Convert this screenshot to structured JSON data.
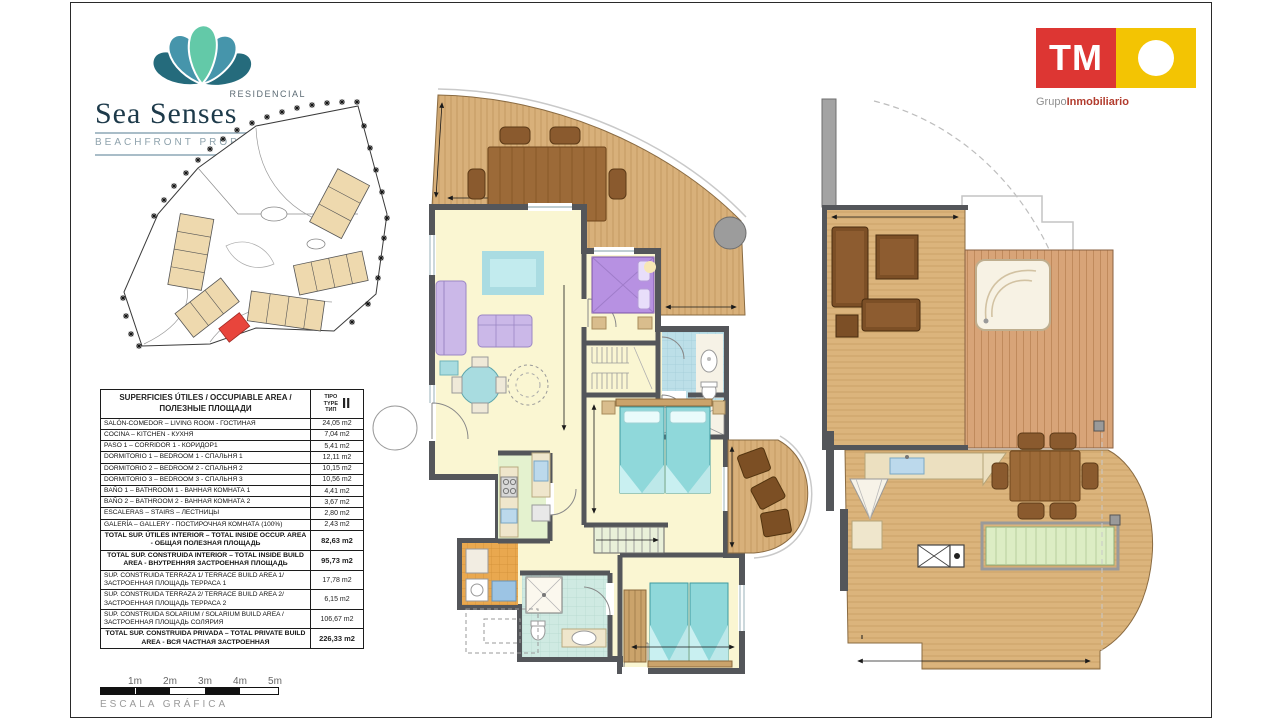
{
  "branding": {
    "residencial": "RESIDENCIAL",
    "name": "Sea Senses",
    "tagline": "BEACHFRONT PROPERTIES"
  },
  "developer": {
    "initials": "TM",
    "grupo": "Grupo",
    "inmobiliario": "Inmobiliario"
  },
  "area_table": {
    "title": "SUPERFICIES ÚTILES / OCCUPIABLE AREA / ПОЛЕЗНЫЕ ПЛОЩАДИ",
    "type_lines": [
      "TIPO",
      "TYPE",
      "ТИП"
    ],
    "type_value": "II",
    "rows": [
      {
        "label": "SALÓN-COMEDOR – LIVING ROOM - ГОСТИНАЯ",
        "value": "24,05 m2"
      },
      {
        "label": "COCINA – KITCHEN - КУХНЯ",
        "value": "7,04 m2"
      },
      {
        "label": "PASO 1 – CORRIDOR 1 - КОРИДОР1",
        "value": "5,41 m2"
      },
      {
        "label": "DORMITORIO 1 – BEDROOM 1 - СПАЛЬНЯ 1",
        "value": "12,11 m2"
      },
      {
        "label": "DORMITORIO 2 – BEDROOM 2 - СПАЛЬНЯ 2",
        "value": "10,15 m2"
      },
      {
        "label": "DORMITORIO 3 – BEDROOM 3 - СПАЛЬНЯ 3",
        "value": "10,56 m2"
      },
      {
        "label": "BAÑO 1 – BATHROOM 1 - ВАННАЯ КОМНАТА 1",
        "value": "4,41 m2"
      },
      {
        "label": "BAÑO 2 – BATHROOM 2 - ВАННАЯ КОМНАТА 2",
        "value": "3,67 m2"
      },
      {
        "label": "ESCALERAS – STAIRS – ЛЕСТНИЦЫ",
        "value": "2,80 m2"
      },
      {
        "label": "GALERÍA – GALLERY - ПОСТИРОЧНАЯ КОМНАТА (100%)",
        "value": "2,43 m2"
      },
      {
        "label": "TOTAL SUP. ÚTILES INTERIOR – TOTAL INSIDE OCCUP. AREA - ОБЩАЯ ПОЛЕЗНАЯ ПЛОЩАДЬ",
        "value": "82,63 m2"
      },
      {
        "label": "TOTAL SUP. CONSTRUIDA INTERIOR – TOTAL INSIDE BUILD AREA - ВНУТРЕННЯЯ ЗАСТРОЕННАЯ ПЛОЩАДЬ",
        "value": "95,73 m2"
      },
      {
        "label": "SUP. CONSTRUIDA TERRAZA 1/ TERRACE BUILD AREA 1/ ЗАСТРОЕННАЯ ПЛОЩАДЬ ТЕРРАСА 1",
        "value": "17,78 m2"
      },
      {
        "label": "SUP. CONSTRUIDA TERRAZA 2/ TERRACE BUILD AREA 2/ ЗАСТРОЕННАЯ ПЛОЩАДЬ ТЕРРАСА 2",
        "value": "6,15 m2"
      },
      {
        "label": "SUP. CONSTRUIDA SOLARIUM / SOLARIUM BUILD AREA / ЗАСТРОЕННАЯ ПЛОЩАДЬ СОЛЯРИЯ",
        "value": "106,67 m2"
      },
      {
        "label": "TOTAL SUP. CONSTRUIDA PRIVADA – TOTAL PRIVATE BUILD AREA - ВСЯ ЧАСТНАЯ ЗАСТРОЕННАЯ",
        "value": "226,33 m2"
      }
    ]
  },
  "scale": {
    "labels": [
      "1m",
      "2m",
      "3m",
      "4m",
      "5m"
    ],
    "caption": "ESCALA  GRÁFICA"
  },
  "colors": {
    "wall": "#54565a",
    "floor_yellow": "#faf6d2",
    "terrace_wood": "#d8b07a",
    "bed_teal": "#8fd8da",
    "bed_purple": "#b791e2",
    "brand_red": "#dd3633",
    "brand_yellow": "#f3c403",
    "highlight_unit_red": "#e8453c"
  }
}
